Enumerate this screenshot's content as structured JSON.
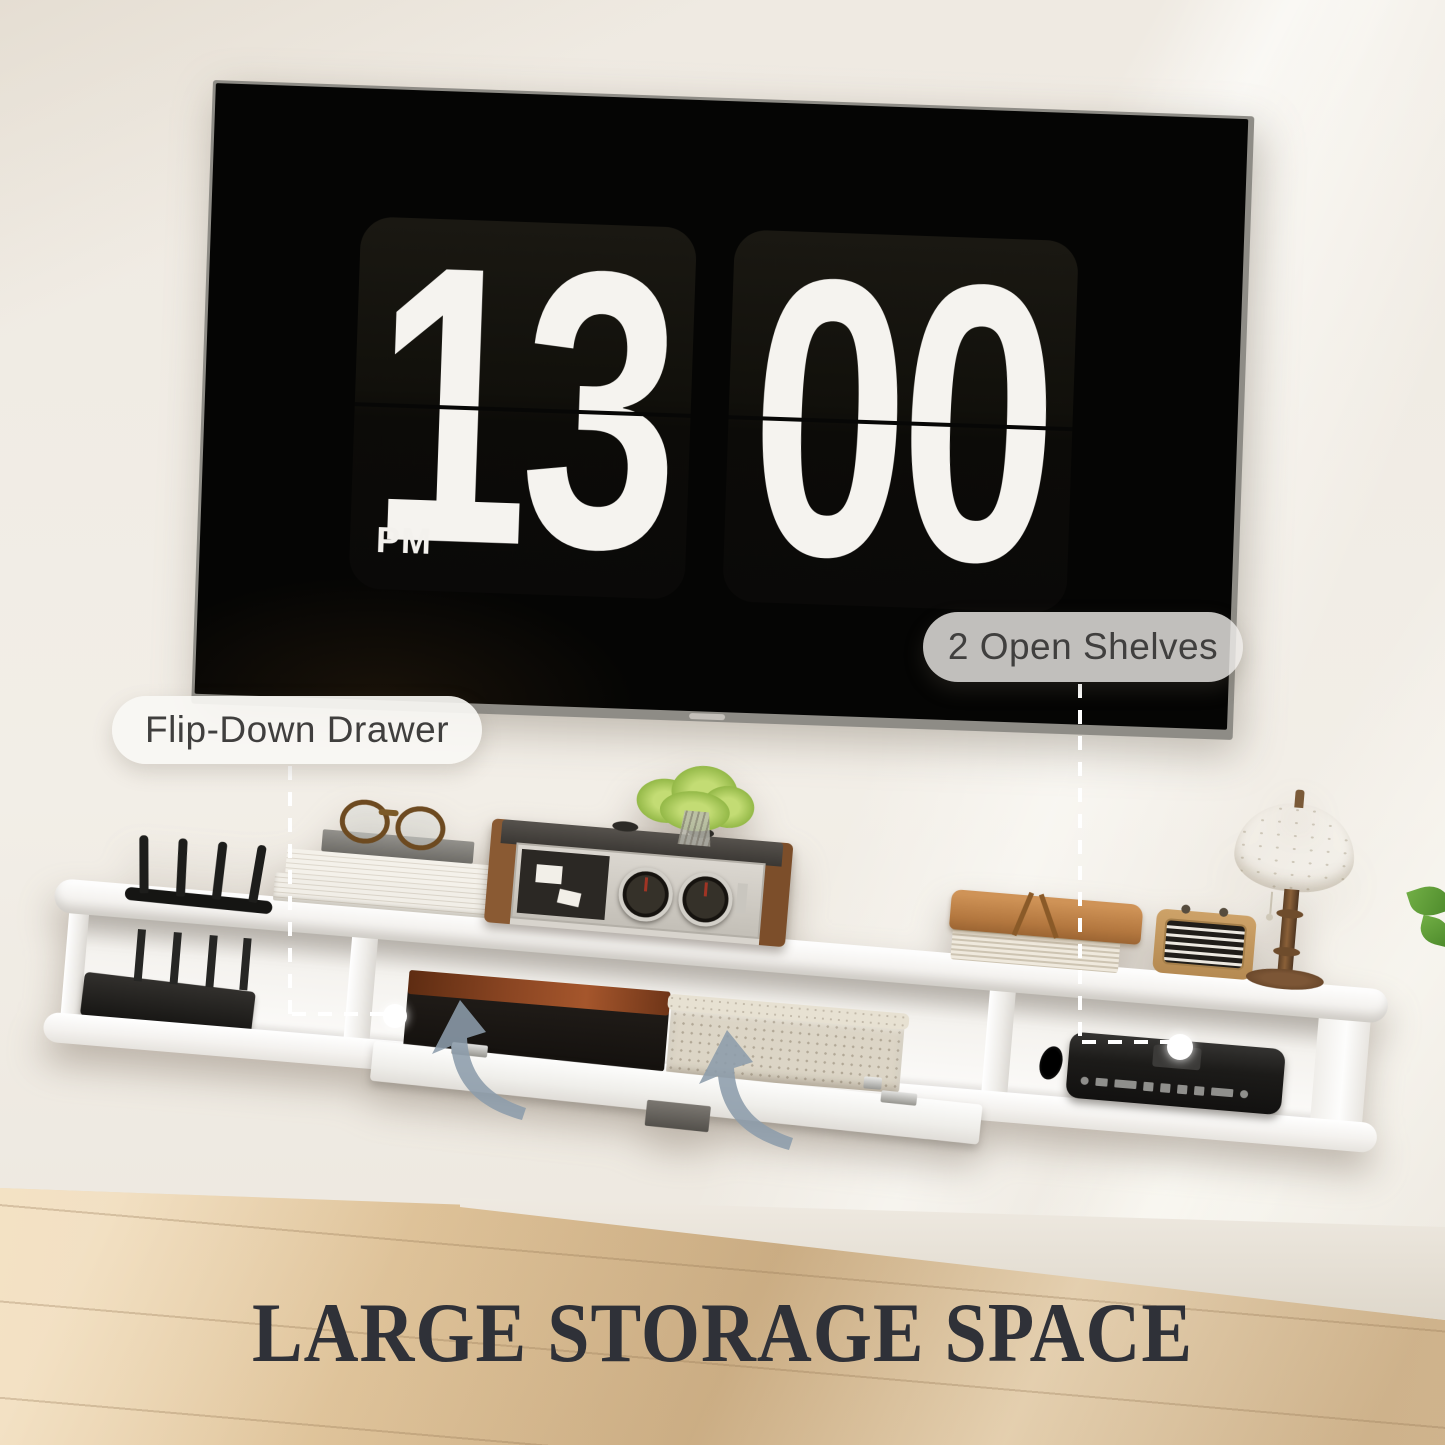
{
  "clock": {
    "hours": "13",
    "minutes": "00",
    "meridiem": "PM"
  },
  "callouts": {
    "drawer_label": "Flip-Down Drawer",
    "shelves_label": "2 Open Shelves"
  },
  "title": "LARGE STORAGE SPACE",
  "colors": {
    "wall": "#f0ece4",
    "floor_wood": "#dabd93",
    "tv_screen": "#050504",
    "flip_card": "#11100b",
    "digits": "#f5f3ef",
    "pill_background": "rgba(249,247,244,0.92)",
    "pill_text": "#403f3e",
    "arrow": "#8c9dab",
    "shelf": "#f7f5f2",
    "title_text": "#2f3138"
  }
}
